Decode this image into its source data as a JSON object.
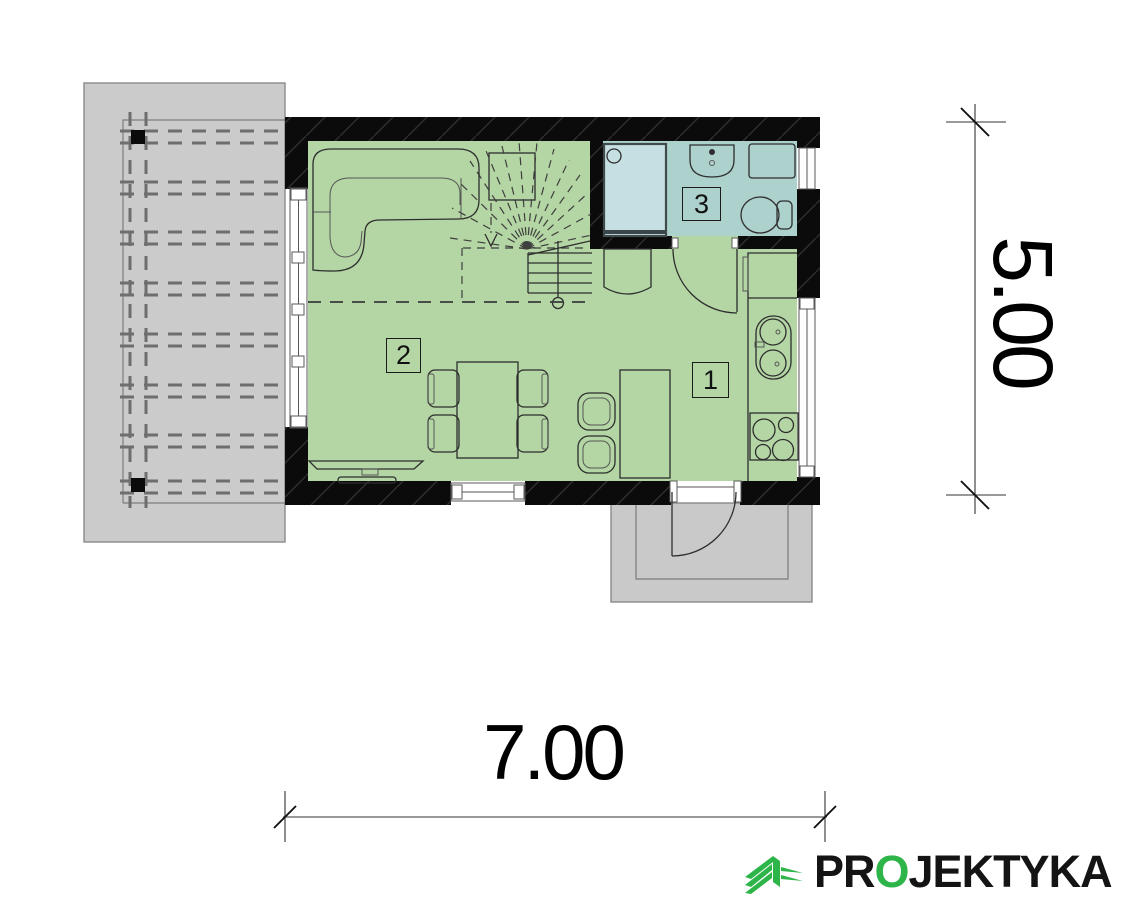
{
  "rooms": [
    {
      "number": "1"
    },
    {
      "number": "2"
    },
    {
      "number": "3"
    }
  ],
  "dimensions": {
    "width_meters": "7.00",
    "height_meters": "5.00"
  },
  "branding": {
    "icon": "green-building-icon",
    "logo_prefix": "PR",
    "logo_o": "O",
    "logo_suffix": "JEKTYKA",
    "logo_full": "PROJEKTYKA"
  },
  "colors": {
    "floor_green": "#b4d6a4",
    "bathroom_teal": "#add1cc",
    "shower_blue": "#c6dfe3",
    "terrace_gray": "#cbcbcb",
    "wall_black": "#0b0b0b",
    "logo_green": "#2db549"
  }
}
